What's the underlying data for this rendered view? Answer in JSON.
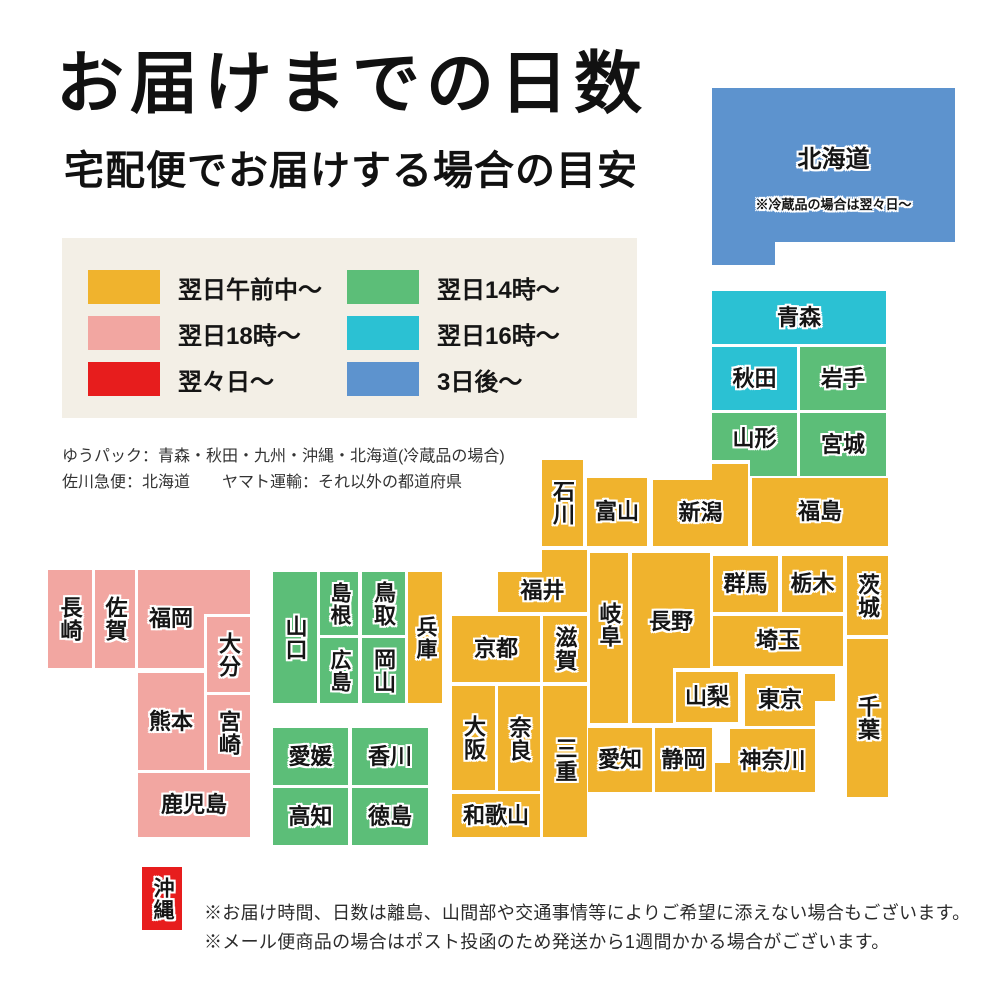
{
  "header": {
    "title": "お届けまでの日数",
    "subtitle": "宅配便でお届けする場合の目安"
  },
  "colors": {
    "yellow": "#F0B32D",
    "green": "#5CBE78",
    "cyan": "#2BC1D3",
    "blue": "#5D93CE",
    "pink": "#F2A6A1",
    "red": "#E71D1D",
    "legend_bg": "#F3EFE6"
  },
  "legend": {
    "items": [
      {
        "color": "yellow",
        "label": "翌日午前中〜"
      },
      {
        "color": "pink",
        "label": "翌日18時〜"
      },
      {
        "color": "red",
        "label": "翌々日〜"
      },
      {
        "color": "green",
        "label": "翌日14時〜"
      },
      {
        "color": "cyan",
        "label": "翌日16時〜"
      },
      {
        "color": "blue",
        "label": "3日後〜"
      }
    ]
  },
  "carrier_note": {
    "line1": "ゆうパック：青森・秋田・九州・沖縄・北海道(冷蔵品の場合)",
    "line2": "佐川急便：北海道　　ヤマト運輸：それ以外の都道府県"
  },
  "footer": {
    "line1": "※お届け時間、日数は離島、山間部や交通事情等によりご希望に添えない場合もございます。",
    "line2": "※メール便商品の場合はポスト投函のため発送から1週間かかる場合がございます。"
  },
  "map": {
    "blocks": [
      {
        "name": "hokkaido",
        "label": "北海道",
        "color": "blue",
        "vertical": false,
        "fontSize": 24,
        "rects": [
          [
            712,
            88,
            243,
            154
          ],
          [
            712,
            88,
            63,
            177
          ]
        ],
        "labelBox": [
          712,
          130,
          243,
          60
        ]
      },
      {
        "name": "hokkaido-note",
        "label": "※冷蔵品の場合は翌々日〜",
        "color": "blue",
        "note": true,
        "vertical": false,
        "fontSize": 13,
        "rects": [],
        "labelBox": [
          712,
          192,
          243,
          26
        ]
      },
      {
        "name": "aomori",
        "label": "青森",
        "color": "cyan",
        "vertical": false,
        "rects": [
          [
            712,
            291,
            174,
            53
          ]
        ]
      },
      {
        "name": "akita",
        "label": "秋田",
        "color": "cyan",
        "vertical": false,
        "rects": [
          [
            712,
            347,
            85,
            63
          ]
        ]
      },
      {
        "name": "iwate",
        "label": "岩手",
        "color": "green",
        "vertical": false,
        "rects": [
          [
            800,
            347,
            86,
            63
          ]
        ]
      },
      {
        "name": "yamagata",
        "label": "山形",
        "color": "green",
        "vertical": false,
        "rects": [
          [
            712,
            413,
            85,
            47
          ],
          [
            750,
            413,
            47,
            63
          ]
        ],
        "labelBox": [
          712,
          413,
          85,
          52
        ]
      },
      {
        "name": "miyagi",
        "label": "宮城",
        "color": "green",
        "vertical": false,
        "rects": [
          [
            800,
            413,
            86,
            63
          ]
        ]
      },
      {
        "name": "ishikawa",
        "label": "石川",
        "color": "yellow",
        "vertical": true,
        "rects": [
          [
            542,
            460,
            41,
            86
          ]
        ]
      },
      {
        "name": "toyama",
        "label": "富山",
        "color": "yellow",
        "vertical": false,
        "rects": [
          [
            587,
            478,
            60,
            68
          ]
        ]
      },
      {
        "name": "niigata",
        "label": "新潟",
        "color": "yellow",
        "vertical": false,
        "rects": [
          [
            653,
            480,
            95,
            66
          ],
          [
            712,
            464,
            36,
            18
          ]
        ],
        "labelBox": [
          653,
          480,
          95,
          66
        ]
      },
      {
        "name": "fukushima",
        "label": "福島",
        "color": "yellow",
        "vertical": false,
        "rects": [
          [
            752,
            478,
            136,
            68
          ]
        ]
      },
      {
        "name": "fukui",
        "label": "福井",
        "color": "yellow",
        "vertical": false,
        "rects": [
          [
            498,
            572,
            89,
            40
          ],
          [
            542,
            550,
            45,
            23
          ]
        ],
        "labelBox": [
          498,
          570,
          89,
          42
        ]
      },
      {
        "name": "gifu",
        "label": "岐阜",
        "color": "yellow",
        "vertical": true,
        "rects": [
          [
            590,
            553,
            38,
            170
          ]
        ],
        "labelBox": [
          590,
          570,
          38,
          110
        ]
      },
      {
        "name": "nagano",
        "label": "長野",
        "color": "yellow",
        "vertical": false,
        "rects": [
          [
            632,
            553,
            78,
            115
          ],
          [
            632,
            553,
            41,
            170
          ]
        ],
        "labelBox": [
          632,
          582,
          78,
          80
        ]
      },
      {
        "name": "gunma",
        "label": "群馬",
        "color": "yellow",
        "vertical": false,
        "rects": [
          [
            713,
            556,
            65,
            56
          ]
        ]
      },
      {
        "name": "tochigi",
        "label": "栃木",
        "color": "yellow",
        "vertical": false,
        "rects": [
          [
            782,
            556,
            61,
            56
          ]
        ]
      },
      {
        "name": "ibaraki",
        "label": "茨城",
        "color": "yellow",
        "vertical": true,
        "rects": [
          [
            847,
            556,
            41,
            79
          ]
        ]
      },
      {
        "name": "saitama",
        "label": "埼玉",
        "color": "yellow",
        "vertical": false,
        "rects": [
          [
            713,
            616,
            130,
            50
          ]
        ]
      },
      {
        "name": "chiba",
        "label": "千葉",
        "color": "yellow",
        "vertical": true,
        "rects": [
          [
            847,
            639,
            41,
            158
          ]
        ]
      },
      {
        "name": "yamanashi",
        "label": "山梨",
        "color": "yellow",
        "vertical": false,
        "rects": [
          [
            676,
            672,
            62,
            50
          ]
        ]
      },
      {
        "name": "tokyo",
        "label": "東京",
        "color": "yellow",
        "vertical": false,
        "rects": [
          [
            745,
            674,
            70,
            52
          ],
          [
            745,
            674,
            90,
            27
          ]
        ],
        "labelBox": [
          745,
          674,
          70,
          52
        ]
      },
      {
        "name": "kanagawa",
        "label": "神奈川",
        "color": "yellow",
        "vertical": false,
        "rects": [
          [
            730,
            729,
            85,
            63
          ],
          [
            715,
            763,
            100,
            29
          ]
        ],
        "labelBox": [
          730,
          729,
          85,
          63
        ]
      },
      {
        "name": "shiga",
        "label": "滋賀",
        "color": "yellow",
        "vertical": true,
        "rects": [
          [
            543,
            616,
            44,
            66
          ]
        ]
      },
      {
        "name": "kyoto",
        "label": "京都",
        "color": "yellow",
        "vertical": false,
        "rects": [
          [
            452,
            616,
            88,
            66
          ]
        ]
      },
      {
        "name": "osaka",
        "label": "大阪",
        "color": "yellow",
        "vertical": true,
        "rects": [
          [
            452,
            686,
            43,
            104
          ]
        ]
      },
      {
        "name": "nara",
        "label": "奈良",
        "color": "yellow",
        "vertical": true,
        "rects": [
          [
            498,
            686,
            42,
            105
          ]
        ]
      },
      {
        "name": "mie",
        "label": "三重",
        "color": "yellow",
        "vertical": true,
        "rects": [
          [
            543,
            686,
            44,
            151
          ]
        ],
        "labelBox": [
          543,
          700,
          44,
          120
        ]
      },
      {
        "name": "wakayama",
        "label": "和歌山",
        "color": "yellow",
        "vertical": false,
        "rects": [
          [
            452,
            794,
            88,
            43
          ]
        ]
      },
      {
        "name": "aichi",
        "label": "愛知",
        "color": "yellow",
        "vertical": false,
        "rects": [
          [
            588,
            728,
            64,
            64
          ]
        ]
      },
      {
        "name": "shizuoka",
        "label": "静岡",
        "color": "yellow",
        "vertical": false,
        "rects": [
          [
            655,
            728,
            57,
            64
          ]
        ]
      },
      {
        "name": "hyogo",
        "label": "兵庫",
        "color": "yellow",
        "vertical": true,
        "fontSize": 21,
        "rects": [
          [
            408,
            572,
            34,
            131
          ]
        ]
      },
      {
        "name": "tottori",
        "label": "鳥取",
        "color": "green",
        "vertical": true,
        "rects": [
          [
            362,
            572,
            43,
            63
          ]
        ]
      },
      {
        "name": "shimane",
        "label": "島根",
        "color": "green",
        "vertical": true,
        "fontSize": 21,
        "rects": [
          [
            320,
            572,
            38,
            63
          ]
        ]
      },
      {
        "name": "okayama",
        "label": "岡山",
        "color": "green",
        "vertical": true,
        "rects": [
          [
            362,
            638,
            43,
            65
          ]
        ]
      },
      {
        "name": "hiroshima",
        "label": "広島",
        "color": "green",
        "vertical": true,
        "fontSize": 21,
        "rects": [
          [
            320,
            638,
            38,
            65
          ]
        ]
      },
      {
        "name": "yamaguchi",
        "label": "山口",
        "color": "green",
        "vertical": true,
        "rects": [
          [
            273,
            572,
            44,
            131
          ]
        ]
      },
      {
        "name": "ehime",
        "label": "愛媛",
        "color": "green",
        "vertical": false,
        "rects": [
          [
            273,
            728,
            75,
            57
          ]
        ]
      },
      {
        "name": "kagawa",
        "label": "香川",
        "color": "green",
        "vertical": false,
        "rects": [
          [
            352,
            728,
            76,
            57
          ]
        ]
      },
      {
        "name": "kochi",
        "label": "高知",
        "color": "green",
        "vertical": false,
        "rects": [
          [
            273,
            788,
            75,
            57
          ]
        ]
      },
      {
        "name": "tokushima",
        "label": "徳島",
        "color": "green",
        "vertical": false,
        "rects": [
          [
            352,
            788,
            76,
            57
          ]
        ]
      },
      {
        "name": "fukuoka",
        "label": "福岡",
        "color": "pink",
        "vertical": false,
        "rects": [
          [
            138,
            570,
            112,
            44
          ],
          [
            138,
            570,
            66,
            98
          ]
        ],
        "labelBox": [
          138,
          590,
          66,
          58
        ]
      },
      {
        "name": "saga",
        "label": "佐賀",
        "color": "pink",
        "vertical": true,
        "rects": [
          [
            95,
            570,
            40,
            98
          ]
        ]
      },
      {
        "name": "nagasaki",
        "label": "長崎",
        "color": "pink",
        "vertical": true,
        "rects": [
          [
            48,
            570,
            44,
            98
          ]
        ]
      },
      {
        "name": "oita",
        "label": "大分",
        "color": "pink",
        "vertical": true,
        "rects": [
          [
            207,
            617,
            43,
            75
          ]
        ]
      },
      {
        "name": "kumamoto",
        "label": "熊本",
        "color": "pink",
        "vertical": false,
        "rects": [
          [
            138,
            673,
            66,
            97
          ]
        ]
      },
      {
        "name": "miyazaki",
        "label": "宮崎",
        "color": "pink",
        "vertical": true,
        "rects": [
          [
            207,
            695,
            43,
            75
          ]
        ]
      },
      {
        "name": "kagoshima",
        "label": "鹿児島",
        "color": "pink",
        "vertical": false,
        "rects": [
          [
            138,
            773,
            112,
            64
          ]
        ]
      },
      {
        "name": "okinawa",
        "label": "沖縄",
        "color": "red",
        "vertical": true,
        "fontSize": 21,
        "rects": [
          [
            142,
            867,
            40,
            63
          ]
        ]
      }
    ]
  }
}
